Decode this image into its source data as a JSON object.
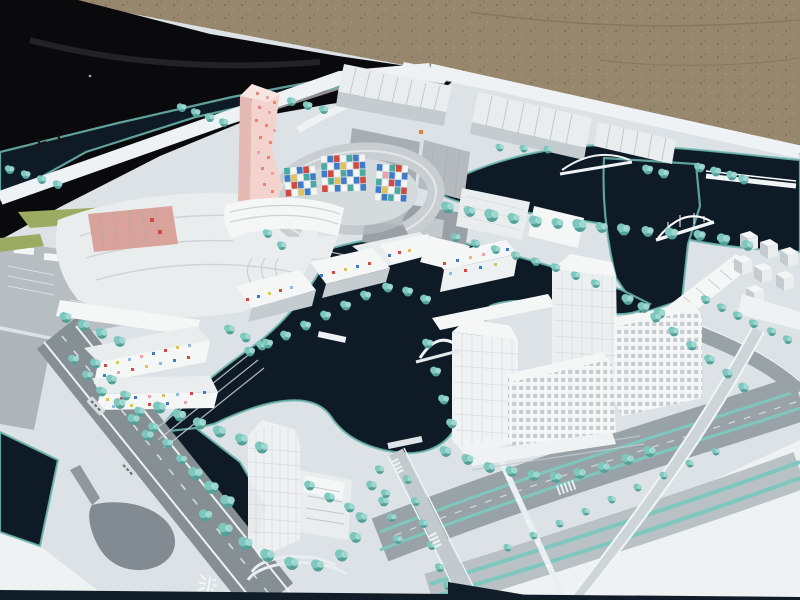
{
  "scene": {
    "description": "Outdoor photograph of a white architectural city-planning scale model viewed at an angle. Black tarp and brown gravel behind the board. The model shows white buildings, a twisted pink-dotted tower, a circular courtyard building with colorful mosaic panels, confetti-dotted housing blocks, dark navy canals with arched bridges, teal model trees, gray boulevards with teal medians and a curved flyover ramp."
  },
  "palette": {
    "gravel": "#97876d",
    "gravel_shade": "#7b6c56",
    "tarp": "#0a0a0c",
    "tarp_fold": "#38383e",
    "board": "#dce2e5",
    "board_bright": "#eef2f3",
    "water": "#0e1b27",
    "water_edge": "#6fbab1",
    "tree": "#7ec7bf",
    "tree_dark": "#53a098",
    "tree_light": "#aadfd8",
    "road": "#99a2a7",
    "road_dark": "#868f94",
    "road_light": "#c2cacd",
    "curb": "#eef2f4",
    "building": "#e9edee",
    "building_bright": "#f5f7f7",
    "building_shade": "#c5ccd0",
    "building_dark": "#a5acb1",
    "slab": "#9aa1a6",
    "roof": "#c8ced1",
    "courtyard": "#d5dadd",
    "pink": "#f4d3ce",
    "pink_side": "#e5bab4",
    "salmon": "#d9a39b",
    "green": "#9cab62",
    "shadow": "#27323f",
    "glyph": "#17181a"
  },
  "mosaic_colors": {
    "r": "#d2493d",
    "b": "#3d7cc9",
    "t": "#49ab9f",
    "y": "#e2c257",
    "w": "#f4f6f6",
    "p": "#eba3ab",
    "o": "#dd8040",
    "lb": "#8db8e8",
    "pk": "#e8857a"
  },
  "mosaics": {
    "crescent_panel_left": {
      "rows": [
        [
          "t",
          "w",
          "b",
          "r",
          "w"
        ],
        [
          "b",
          "y",
          "w",
          "t",
          "b"
        ],
        [
          "w",
          "r",
          "b",
          "w",
          "t"
        ],
        [
          "r",
          "w",
          "y",
          "b",
          "w"
        ]
      ]
    },
    "crescent_panel_center": {
      "rows": [
        [
          "w",
          "b",
          "r",
          "w",
          "t",
          "b",
          "w"
        ],
        [
          "t",
          "w",
          "b",
          "y",
          "w",
          "r",
          "b"
        ],
        [
          "b",
          "r",
          "w",
          "t",
          "b",
          "w",
          "t"
        ],
        [
          "w",
          "t",
          "y",
          "b",
          "w",
          "b",
          "r"
        ],
        [
          "r",
          "w",
          "b",
          "w",
          "t",
          "w",
          "b"
        ]
      ]
    },
    "crescent_panel_right": {
      "rows": [
        [
          "b",
          "w",
          "t",
          "r",
          "w"
        ],
        [
          "w",
          "p",
          "b",
          "w",
          "b"
        ],
        [
          "t",
          "w",
          "r",
          "b",
          "w"
        ],
        [
          "b",
          "y",
          "w",
          "t",
          "r"
        ],
        [
          "w",
          "b",
          "t",
          "w",
          "b"
        ]
      ]
    }
  },
  "dots": {
    "pink_tower": [
      [
        256,
        92,
        "pk"
      ],
      [
        266,
        96,
        "p"
      ],
      [
        273,
        101,
        "pk"
      ],
      [
        258,
        106,
        "pk"
      ],
      [
        268,
        111,
        "p"
      ],
      [
        255,
        119,
        "pk"
      ],
      [
        265,
        124,
        "pk"
      ],
      [
        273,
        129,
        "p"
      ],
      [
        259,
        136,
        "pk"
      ],
      [
        269,
        141,
        "pk"
      ],
      [
        257,
        151,
        "p"
      ],
      [
        267,
        156,
        "pk"
      ],
      [
        261,
        167,
        "pk"
      ],
      [
        271,
        172,
        "p"
      ],
      [
        263,
        183,
        "pk"
      ],
      [
        271,
        190,
        "pk"
      ],
      [
        261,
        198,
        "p"
      ],
      [
        268,
        204,
        "pk"
      ]
    ],
    "confetti_upper": [
      [
        104,
        364,
        "r"
      ],
      [
        116,
        361,
        "y"
      ],
      [
        128,
        358,
        "lb"
      ],
      [
        140,
        355,
        "p"
      ],
      [
        152,
        352,
        "b"
      ],
      [
        164,
        349,
        "r"
      ],
      [
        176,
        346,
        "y"
      ],
      [
        188,
        344,
        "lb"
      ],
      [
        103,
        374,
        "b"
      ],
      [
        117,
        371,
        "p"
      ],
      [
        131,
        368,
        "r"
      ],
      [
        145,
        365,
        "y"
      ],
      [
        159,
        362,
        "lb"
      ],
      [
        173,
        359,
        "b"
      ],
      [
        187,
        356,
        "r"
      ]
    ],
    "confetti_lower": [
      [
        106,
        398,
        "y"
      ],
      [
        120,
        397,
        "r"
      ],
      [
        134,
        396,
        "b"
      ],
      [
        148,
        395,
        "p"
      ],
      [
        162,
        394,
        "y"
      ],
      [
        176,
        393,
        "lb"
      ],
      [
        190,
        392,
        "r"
      ],
      [
        203,
        391,
        "b"
      ],
      [
        112,
        405,
        "lb"
      ],
      [
        130,
        404,
        "y"
      ],
      [
        148,
        403,
        "r"
      ],
      [
        166,
        402,
        "b"
      ],
      [
        184,
        401,
        "p"
      ]
    ],
    "residential": [
      [
        246,
        298,
        "r"
      ],
      [
        257,
        295,
        "b"
      ],
      [
        268,
        292,
        "y"
      ],
      [
        279,
        289,
        "r"
      ],
      [
        290,
        286,
        "lb"
      ],
      [
        320,
        274,
        "b"
      ],
      [
        332,
        271,
        "r"
      ],
      [
        344,
        268,
        "y"
      ],
      [
        356,
        265,
        "b"
      ],
      [
        368,
        262,
        "r"
      ],
      [
        388,
        254,
        "b"
      ],
      [
        398,
        251,
        "r"
      ],
      [
        408,
        249,
        "y"
      ]
    ],
    "slab_block": [
      [
        443,
        262,
        "r"
      ],
      [
        456,
        259,
        "b"
      ],
      [
        469,
        256,
        "y"
      ],
      [
        482,
        253,
        "p"
      ],
      [
        495,
        250,
        "r"
      ],
      [
        506,
        248,
        "b"
      ],
      [
        449,
        272,
        "lb"
      ],
      [
        464,
        269,
        "r"
      ],
      [
        479,
        266,
        "b"
      ],
      [
        494,
        263,
        "y"
      ]
    ],
    "salmon_marks": [
      [
        150,
        218,
        "r"
      ],
      [
        158,
        230,
        "r"
      ]
    ],
    "shed_mark": [
      [
        419,
        130,
        "o"
      ]
    ]
  },
  "markings": {
    "road_symbol": "兴",
    "road_symbol_meaning": "white emblem painted on roadway",
    "board_marks": "small dark character-like marks on board margin",
    "road_labels": "two small illegible white street-name plates"
  }
}
